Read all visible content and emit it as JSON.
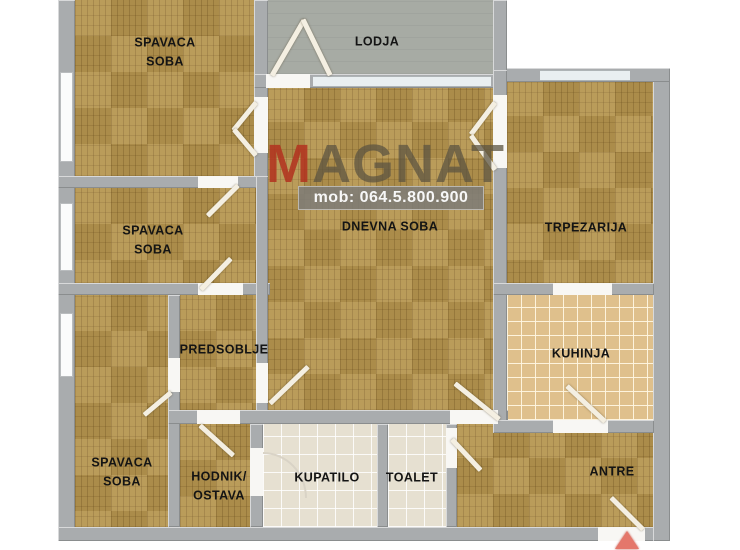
{
  "watermark": {
    "brand_first_letter": "M",
    "brand_rest": "AGNAT",
    "phone": "mob: 064.5.800.900"
  },
  "rooms": {
    "bedroom_top": {
      "line1": "SPAVACA",
      "line2": "SOBA"
    },
    "lodja": {
      "label": "LODJA"
    },
    "living_room": {
      "label": "DNEVNA SOBA"
    },
    "dining_room": {
      "label": "TRPEZARIJA"
    },
    "kitchen": {
      "label": "KUHINJA"
    },
    "bedroom_middle": {
      "line1": "SPAVACA",
      "line2": "SOBA"
    },
    "hallway": {
      "label": "PREDSOBLJE"
    },
    "bedroom_bottom": {
      "line1": "SPAVACA",
      "line2": "SOBA"
    },
    "corridor_storage": {
      "line1": "HODNIK/",
      "line2": "OSTAVA"
    },
    "bathroom": {
      "label": "KUPATILO"
    },
    "toilet": {
      "label": "TOALET"
    },
    "entry_hall": {
      "label": "ANTRE"
    }
  },
  "colors": {
    "wall": "#a9acae",
    "parquet": "#b5944e",
    "lodja_floor": "#a7aba4",
    "kitchen_tile": "#dfc08c",
    "bath_tile": "#e6e0d1",
    "logo_m": "#b23420",
    "logo_rest": "#5c5442",
    "phone_band": "#7e7c76",
    "entry_arrow": "#e4776b"
  }
}
